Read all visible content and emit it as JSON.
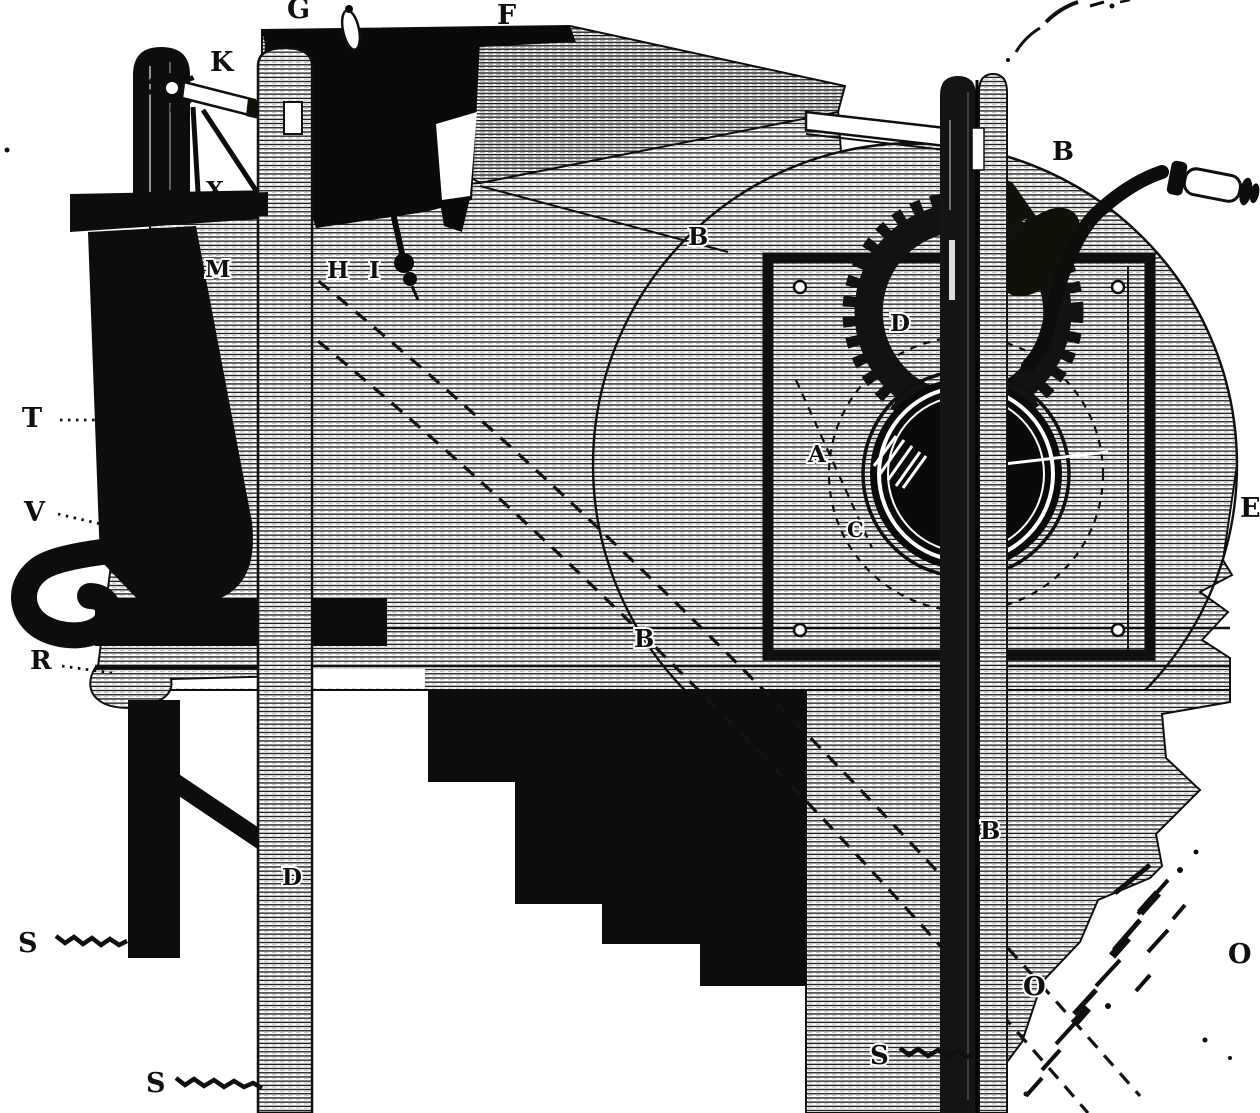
{
  "colors": {
    "ink": "#100f0d",
    "paper": "#ffffff"
  },
  "labels": {
    "g": "G",
    "f": "F",
    "k": "K",
    "x": "X",
    "m": "M",
    "h": "H",
    "i": "I",
    "b_casing": "B",
    "b_crank_post": "B",
    "b_belt_mid": "B",
    "b_belt_low": "B",
    "t": "T",
    "v": "V",
    "r": "R",
    "d_gear": "D",
    "a_drum": "A",
    "c_dashed": "C",
    "d_post": "D",
    "s_ground_left": "S",
    "s_ground_lower": "S",
    "s_ground_mid": "S",
    "o_panel": "O",
    "o_edge": "O",
    "e_edge": "E"
  }
}
